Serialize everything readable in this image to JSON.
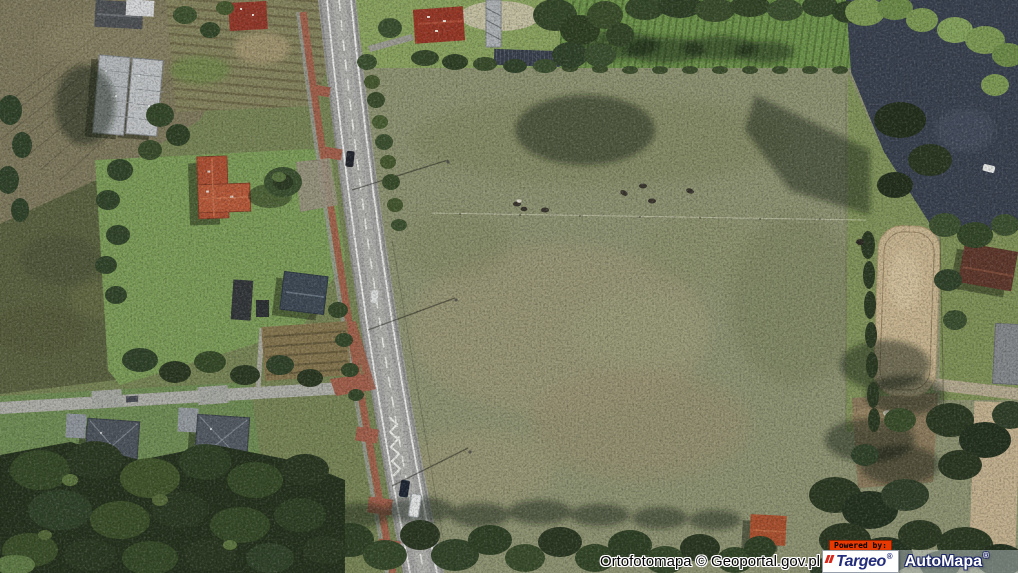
{
  "map": {
    "kind": "aerial-orthophoto"
  },
  "overlay": {
    "attribution": "Ortofotomapa © Geoportal.gov.pl",
    "powered_by": "Powered by:",
    "brand_targeo": "Targeo",
    "brand_automapa": "AutoMapa",
    "reg_mark": "®"
  },
  "palette": {
    "pasture": "#8d9271",
    "plowed_field": "#7e795d",
    "dark_meadow": "#5a6140",
    "forest": "#26331e",
    "road_asphalt": "#a3a3a1",
    "road_marking": "#f2f2ef",
    "sidewalk_brick": "#a2604c",
    "arena_sand": "#c7b48f",
    "pond_water": "#3a4250",
    "roof_orange": "#b75a3a",
    "roof_grey": "#4e555d",
    "powered_by_bg": "#e83a00",
    "targeo_navy": "#232d7a",
    "targeo_red": "#d6281a",
    "automapa_text": "#ffffff"
  }
}
